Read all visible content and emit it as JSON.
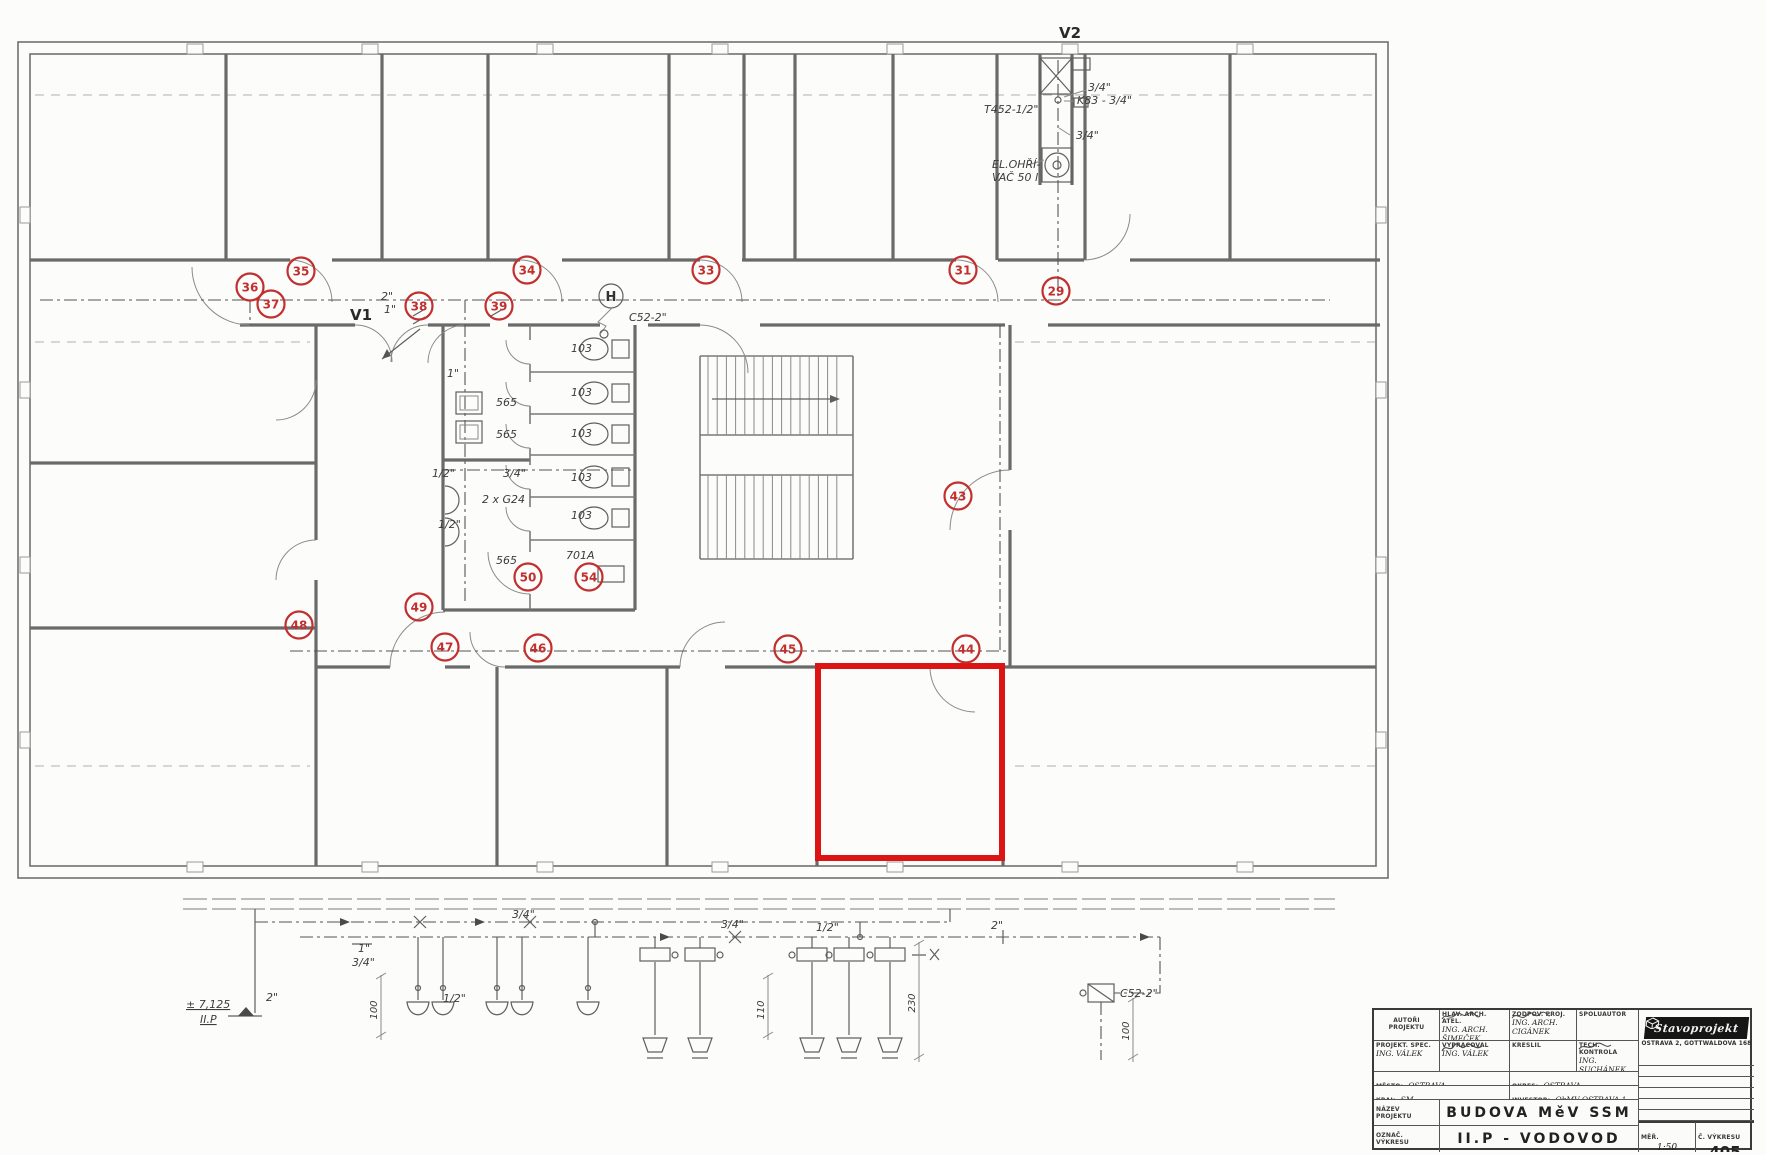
{
  "colors": {
    "marker_red": "#c22f2f",
    "highlight_red": "#dd1414",
    "ink": "#3c3c3c"
  },
  "plan": {
    "riser_v2": "V2",
    "riser_v1": "V1",
    "hydrant_symbol": "H",
    "markers": [
      {
        "n": "35",
        "x": 301,
        "y": 271
      },
      {
        "n": "34",
        "x": 527,
        "y": 270
      },
      {
        "n": "33",
        "x": 706,
        "y": 270
      },
      {
        "n": "31",
        "x": 963,
        "y": 270
      },
      {
        "n": "29",
        "x": 1056,
        "y": 291
      },
      {
        "n": "36",
        "x": 250,
        "y": 287
      },
      {
        "n": "37",
        "x": 271,
        "y": 304
      },
      {
        "n": "38",
        "x": 419,
        "y": 306
      },
      {
        "n": "39",
        "x": 499,
        "y": 306
      },
      {
        "n": "43",
        "x": 958,
        "y": 496
      },
      {
        "n": "44",
        "x": 966,
        "y": 649
      },
      {
        "n": "45",
        "x": 788,
        "y": 649
      },
      {
        "n": "46",
        "x": 538,
        "y": 648
      },
      {
        "n": "47",
        "x": 445,
        "y": 647
      },
      {
        "n": "48",
        "x": 299,
        "y": 625
      },
      {
        "n": "49",
        "x": 419,
        "y": 607
      },
      {
        "n": "50",
        "x": 528,
        "y": 577
      },
      {
        "n": "54",
        "x": 589,
        "y": 577
      }
    ],
    "labels": [
      {
        "t": "3/4\"",
        "x": 1088,
        "y": 91
      },
      {
        "t": "K83 - 3/4\"",
        "x": 1077,
        "y": 104
      },
      {
        "t": "T452-1/2\"",
        "x": 984,
        "y": 113
      },
      {
        "t": "3/4\"",
        "x": 1076,
        "y": 139
      },
      {
        "t": "EL.OHŘÍ-",
        "x": 992,
        "y": 168
      },
      {
        "t": "VAČ 50 l",
        "x": 992,
        "y": 181
      },
      {
        "t": "C52-2\"",
        "x": 629,
        "y": 321
      },
      {
        "t": "2\"",
        "x": 381,
        "y": 300
      },
      {
        "t": "1\"",
        "x": 384,
        "y": 313
      },
      {
        "t": "1\"",
        "x": 447,
        "y": 377
      },
      {
        "t": "103",
        "x": 571,
        "y": 352
      },
      {
        "t": "103",
        "x": 571,
        "y": 396
      },
      {
        "t": "103",
        "x": 571,
        "y": 437
      },
      {
        "t": "103",
        "x": 571,
        "y": 481
      },
      {
        "t": "103",
        "x": 571,
        "y": 519
      },
      {
        "t": "565",
        "x": 496,
        "y": 406
      },
      {
        "t": "565",
        "x": 496,
        "y": 438
      },
      {
        "t": "1/2\"",
        "x": 432,
        "y": 477
      },
      {
        "t": "3/4\"",
        "x": 503,
        "y": 477
      },
      {
        "t": "2 x G24",
        "x": 482,
        "y": 503
      },
      {
        "t": "1/2\"",
        "x": 438,
        "y": 528
      },
      {
        "t": "565",
        "x": 496,
        "y": 564
      },
      {
        "t": "701A",
        "x": 566,
        "y": 559
      }
    ]
  },
  "schematic": {
    "labels": [
      {
        "t": "3/4\"",
        "x": 512,
        "y": 918
      },
      {
        "t": "3/4\"",
        "x": 721,
        "y": 928
      },
      {
        "t": "1/2\"",
        "x": 816,
        "y": 931
      },
      {
        "t": "2\"",
        "x": 991,
        "y": 929
      },
      {
        "t": "1\"",
        "x": 358,
        "y": 952
      },
      {
        "t": "3/4\"",
        "x": 352,
        "y": 966
      },
      {
        "t": "1/2\"",
        "x": 443,
        "y": 1002
      },
      {
        "t": "2\"",
        "x": 266,
        "y": 1001
      },
      {
        "t": "± 7,125",
        "x": 186,
        "y": 1008,
        "cls": "ul"
      },
      {
        "t": "II.P",
        "x": 200,
        "y": 1023,
        "cls": "ul"
      },
      {
        "t": "C52-2\"",
        "x": 1120,
        "y": 997
      }
    ],
    "dims": [
      {
        "t": "100",
        "x": 377,
        "y": 1010
      },
      {
        "t": "110",
        "x": 764,
        "y": 1010
      },
      {
        "t": "230",
        "x": 915,
        "y": 1003
      },
      {
        "t": "100",
        "x": 1129,
        "y": 1031
      }
    ]
  },
  "titleblock": {
    "autori_label": "AUTOŘI PROJEKTU",
    "hlav_label": "HLAV. ARCH. ATEL.",
    "hlav_value": "ING. ARCH. ŠIMEČEK",
    "zodpov_label": "ZODPOV. PROJ.",
    "zodpov_value": "ING. ARCH. CIGÁNEK",
    "spolu_label": "SPOLUAUTOR",
    "spolu_value": "",
    "projspec_label": "PROJEKT. SPEC.",
    "projspec_value": "ING. VÁLEK",
    "vypracoval_label": "VYPRACOVAL",
    "vypracoval_value": "ING. VÁLEK",
    "kreslil_label": "KRESLIL",
    "kreslil_value": "",
    "tech_label": "TECH. KONTROLA",
    "tech_value": "ING. SUCHÁNEK",
    "mesto_label": "MĚSTO:",
    "mesto_value": "OSTRAVA",
    "kraj_label": "KRAJ:",
    "kraj_value": "SM",
    "okres_label": "OKRES:",
    "okres_value": "OSTRAVA",
    "investor_label": "INVESTOR:",
    "investor_value": "ObMV OSTRAVA 1",
    "nazev_label": "NÁZEV PROJEKTU",
    "nazev_value": "BUDOVA MěV SSM",
    "oznac_label": "OZNAČ. VÝKRESU",
    "oznac_value": "II.P - VODOVOD",
    "logo_text": "Stavoprojekt",
    "logo_address": "OSTRAVA 2, GOTTWALDOVA 168",
    "format_label": "FORMÁT",
    "format_value": "",
    "datum_label": "DATUM",
    "datum_value": "2/78",
    "stupen_label": "STUPEŇ PROJ.",
    "stupen_value": "PP",
    "zakazka_label": "Č. ZAKÁZKY",
    "zakazka_value": "07-4-96",
    "arch_label": "ARCH. ČÍS.",
    "arch_value": "",
    "mer_label": "MĚŘ.",
    "mer_value": "1:50",
    "vykres_label": "Č. VÝKRESU",
    "vykres_value": "405"
  }
}
